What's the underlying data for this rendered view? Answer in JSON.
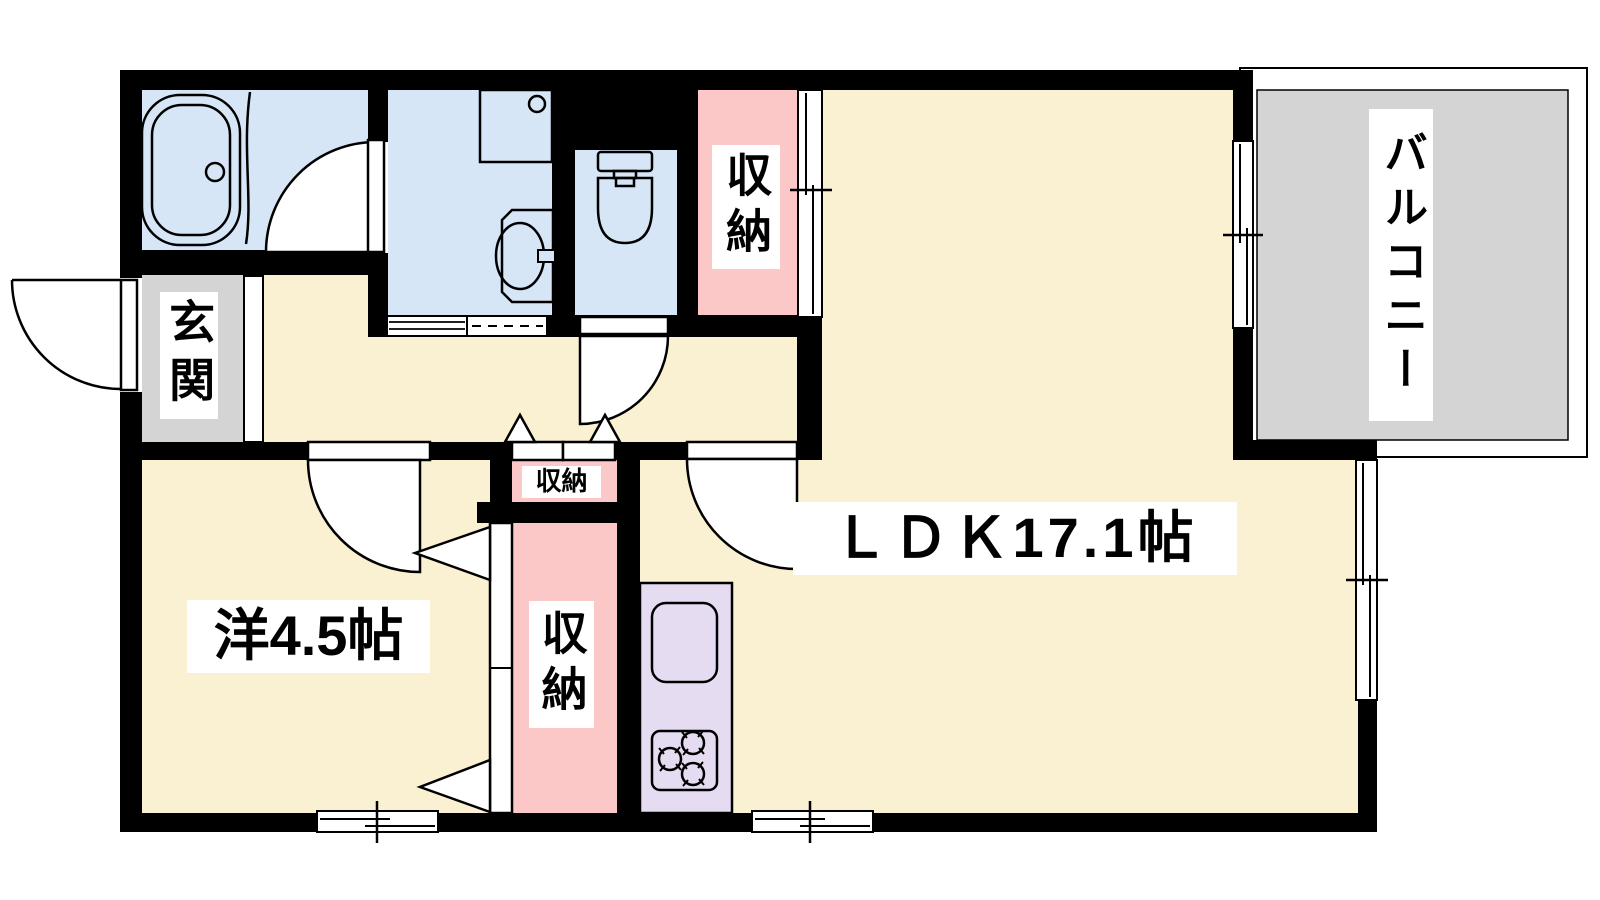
{
  "plan": {
    "unit_labels": {
      "ldk": "ＬＤＫ17.1帖",
      "western_room": "洋4.5帖",
      "entrance": "玄関",
      "balcony": "バルコニー",
      "closet_hall": "収納",
      "closet_mini": "収納",
      "closet_bedroom": "収納"
    },
    "colors": {
      "floor": "#FAF0D2",
      "wet_area": "#D6E6F7",
      "closet": "#FBC7C7",
      "kitchen_counter": "#E6DCF2",
      "balcony_floor": "#D4D4D4",
      "entrance_floor": "#D4D4D4",
      "wall": "#000000",
      "label_bg": "#FFFFFF",
      "text": "#000000"
    },
    "fixtures": [
      "bathtub",
      "bath-door",
      "laundry-counter",
      "washbasin",
      "toilet",
      "kitchen-sink",
      "gas-stove"
    ]
  }
}
